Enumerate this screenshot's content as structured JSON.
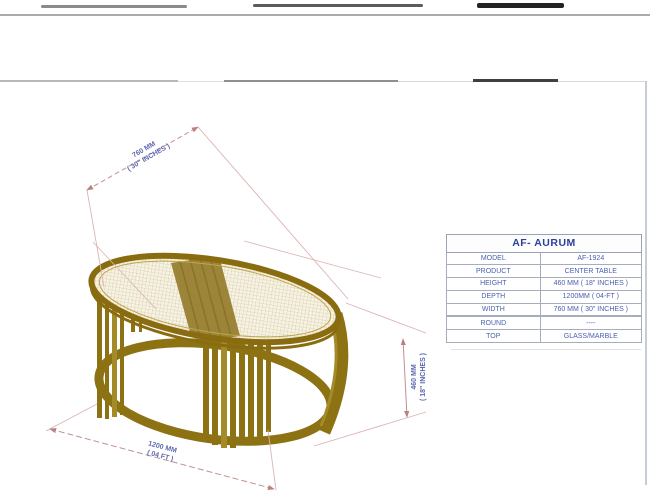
{
  "drawing": {
    "dimensions": {
      "width": {
        "line1": "760 MM",
        "line2": "( 30\" INCHES )"
      },
      "height": {
        "line1": "460 MM",
        "line2": "( 18\" INCHES )"
      },
      "depth": {
        "line1": "1200 MM",
        "line2": "( 04 FT )"
      }
    },
    "colors": {
      "frame_gold": "#8d7213",
      "frame_gold_dark": "#7a6210",
      "frame_gold_light": "#a58a28",
      "mesh_background": "#f6f2e4",
      "mesh_line": "#cdbc8e",
      "dimension_line_pink": "#c48f8f",
      "extension_line_pink": "#dcb3b3",
      "dimension_text_blue": "#5d68b0"
    }
  },
  "spec_table": {
    "title": "AF- AURUM",
    "rows": [
      {
        "label": "MODEL",
        "value": "AF-1924"
      },
      {
        "label": "PRODUCT",
        "value": "CENTER TABLE"
      },
      {
        "label": "HEIGHT",
        "value": "460 MM ( 18\" INCHES )"
      },
      {
        "label": "DEPTH",
        "value": "1200MM ( 04-FT )"
      },
      {
        "label": "WIDTH",
        "value": "760 MM ( 30\" INCHES )"
      },
      {
        "label": "ROUND",
        "value": "----"
      },
      {
        "label": "TOP",
        "value": "GLASS/MARBLE"
      }
    ]
  }
}
